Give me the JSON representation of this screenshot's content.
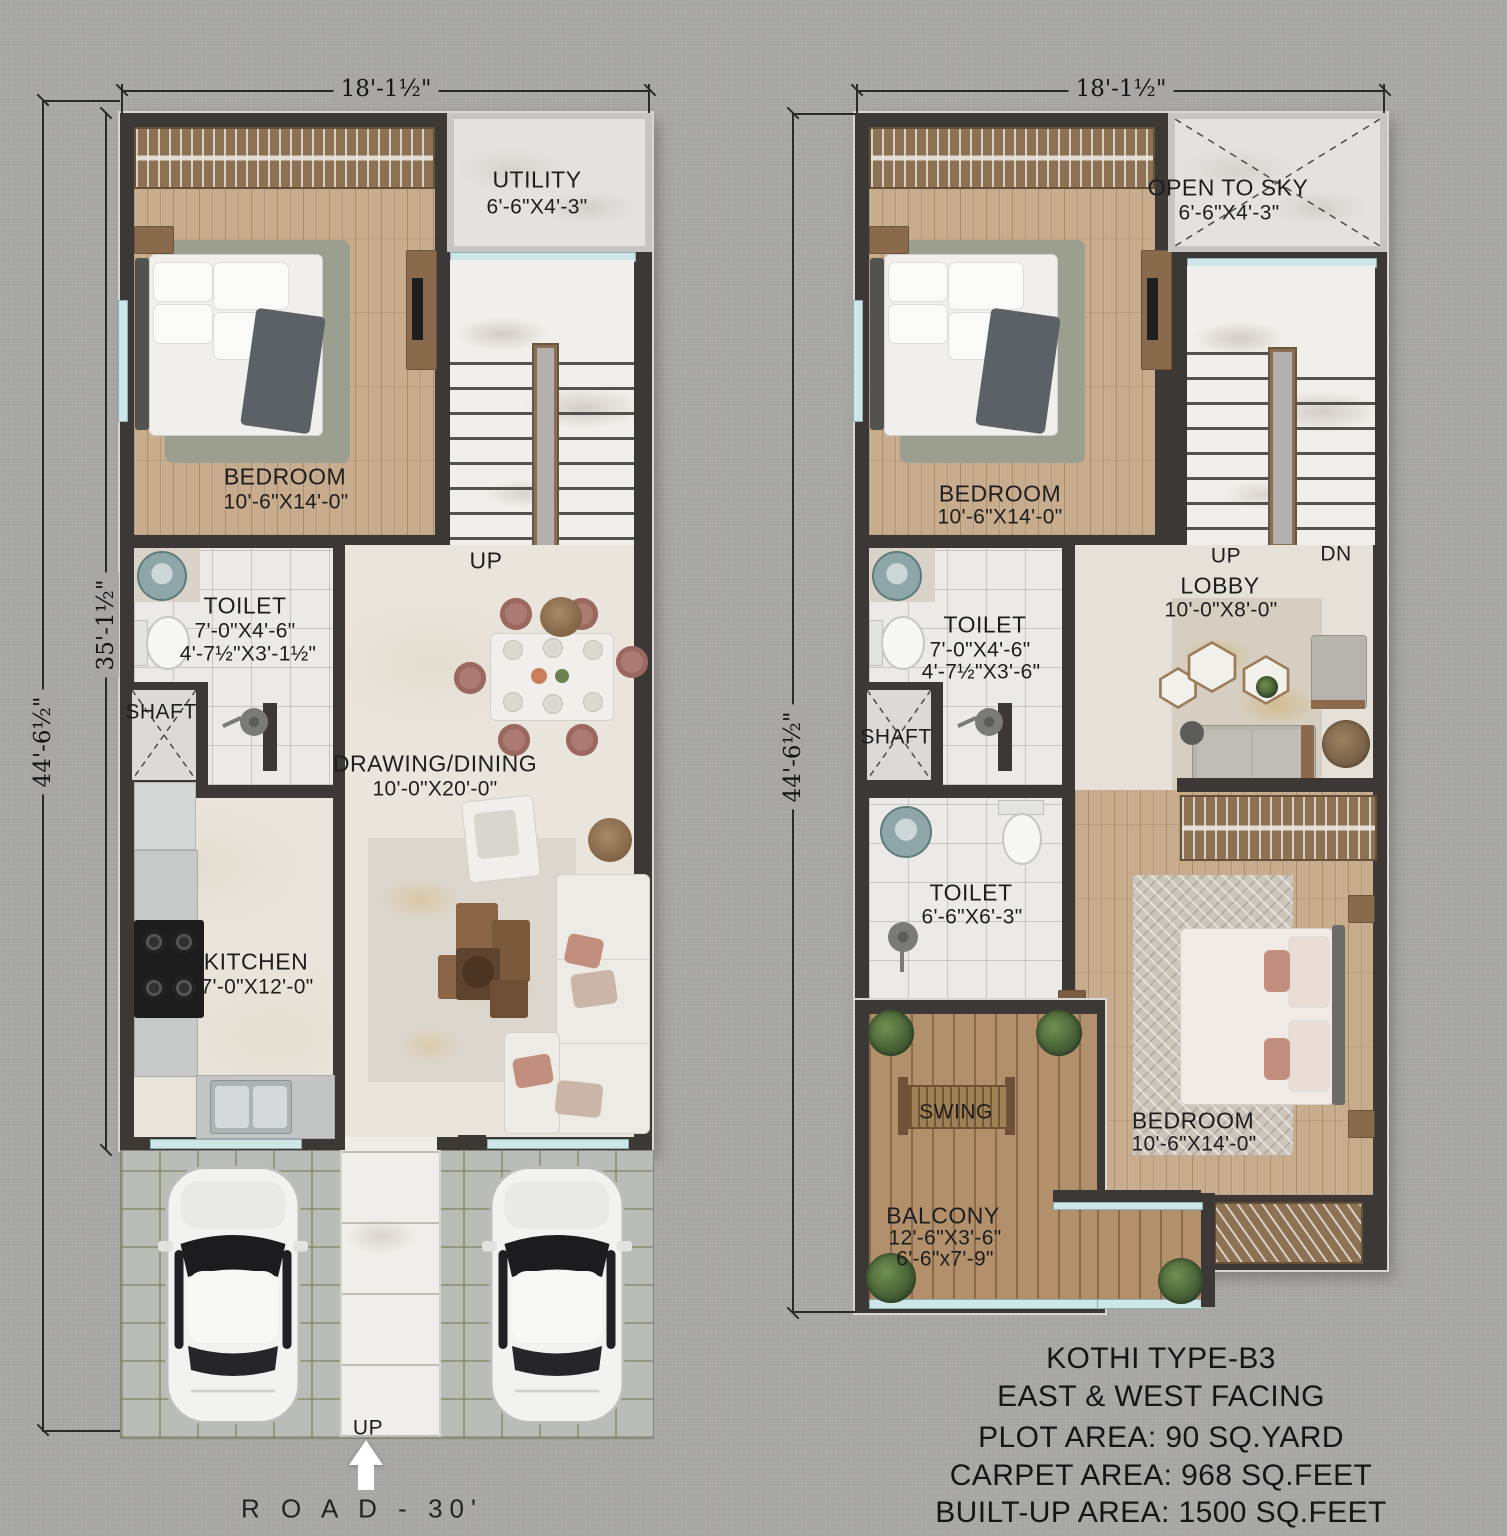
{
  "ground_floor": {
    "dim_top": "18'-1½\"",
    "dim_side_outer": "44'-6½\"",
    "dim_side_inner": "35'-1½\"",
    "utility": {
      "name": "UTILITY",
      "dims": "6'-6\"X4'-3\""
    },
    "bedroom": {
      "name": "BEDROOM",
      "dims": "10'-6\"X14'-0\""
    },
    "stairs_label": "UP",
    "toilet": {
      "name": "TOILET",
      "dims_a": "7'-0\"X4'-6\"",
      "dims_b": "4'-7½\"X3'-1½\""
    },
    "shaft_label": "SHAFT",
    "drawing": {
      "name": "DRAWING/DINING",
      "dims": "10'-0\"X20'-0\""
    },
    "kitchen": {
      "name": "KITCHEN",
      "dims": "7'-0\"X12'-0\""
    },
    "entry_label": "UP",
    "road_label": "R O A D -  30'"
  },
  "first_floor": {
    "dim_top": "18'-1½\"",
    "dim_side": "44'-6½\"",
    "open_to_sky": {
      "name": "OPEN TO SKY",
      "dims": "6'-6\"X4'-3\""
    },
    "bedroom": {
      "name": "BEDROOM",
      "dims": "10'-6\"X14'-0\""
    },
    "stairs_up": "UP",
    "stairs_dn": "DN",
    "lobby": {
      "name": "LOBBY",
      "dims": "10'-0\"X8'-0\""
    },
    "toilet_top": {
      "name": "TOILET",
      "dims_a": "7'-0\"X4'-6\"",
      "dims_b": "4'-7½\"X3'-6\""
    },
    "shaft_label": "SHAFT",
    "toilet_mid": {
      "name": "TOILET",
      "dims": "6'-6\"X6'-3\""
    },
    "swing_label": "SWING",
    "bedroom2": {
      "name": "BEDROOM",
      "dims": "10'-6\"X14'-0\""
    },
    "balcony": {
      "name": "BALCONY",
      "dims_a": "12'-6\"X3'-6\"",
      "dims_b": "6'-6\"x7'-9\""
    }
  },
  "title_block": {
    "line1": "KOTHI TYPE-B3",
    "line2": "EAST & WEST FACING",
    "line3": "PLOT AREA: 90 SQ.YARD",
    "line4": "CARPET AREA: 968 SQ.FEET",
    "line5": "BUILT-UP AREA: 1500 SQ.FEET"
  }
}
